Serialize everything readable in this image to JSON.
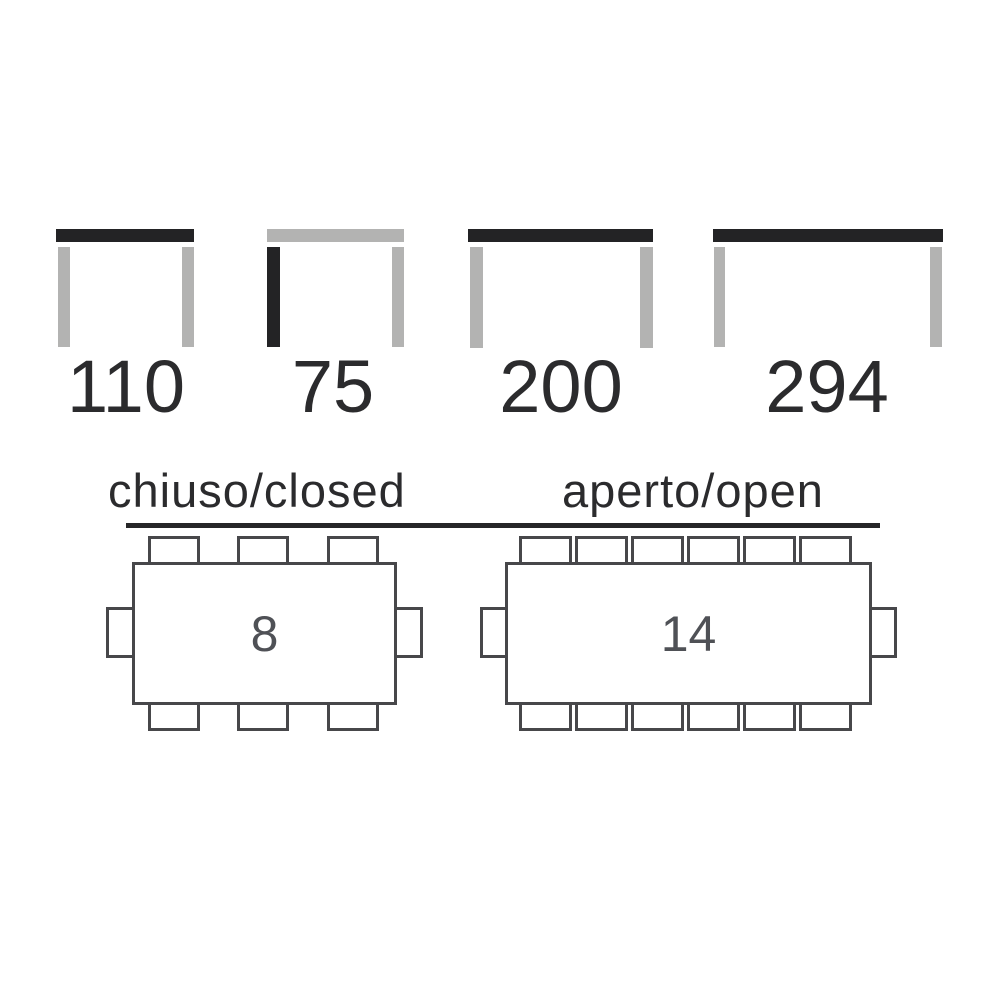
{
  "dims": [
    {
      "value": "110",
      "highlighted_part": "tabletop-width"
    },
    {
      "value": "75",
      "highlighted_part": "leg-height"
    },
    {
      "value": "200",
      "highlighted_part": "tabletop-width"
    },
    {
      "value": "294",
      "highlighted_part": "tabletop-width"
    }
  ],
  "labels": {
    "closed": "chiuso/closed",
    "open": "aperto/open"
  },
  "tables": {
    "closed": {
      "seats": "8",
      "chairs_top": 3,
      "chairs_bottom": 3,
      "chairs_left": 1,
      "chairs_right": 1
    },
    "open": {
      "seats": "14",
      "chairs_top": 6,
      "chairs_bottom": 6,
      "chairs_left": 1,
      "chairs_right": 1
    }
  },
  "colors": {
    "highlight_dark": "#232325",
    "neutral_gray": "#b3b3b2",
    "plan_outline": "#47474a",
    "text_dark": "#2b2b2d",
    "seat_text": "#4f5156"
  }
}
